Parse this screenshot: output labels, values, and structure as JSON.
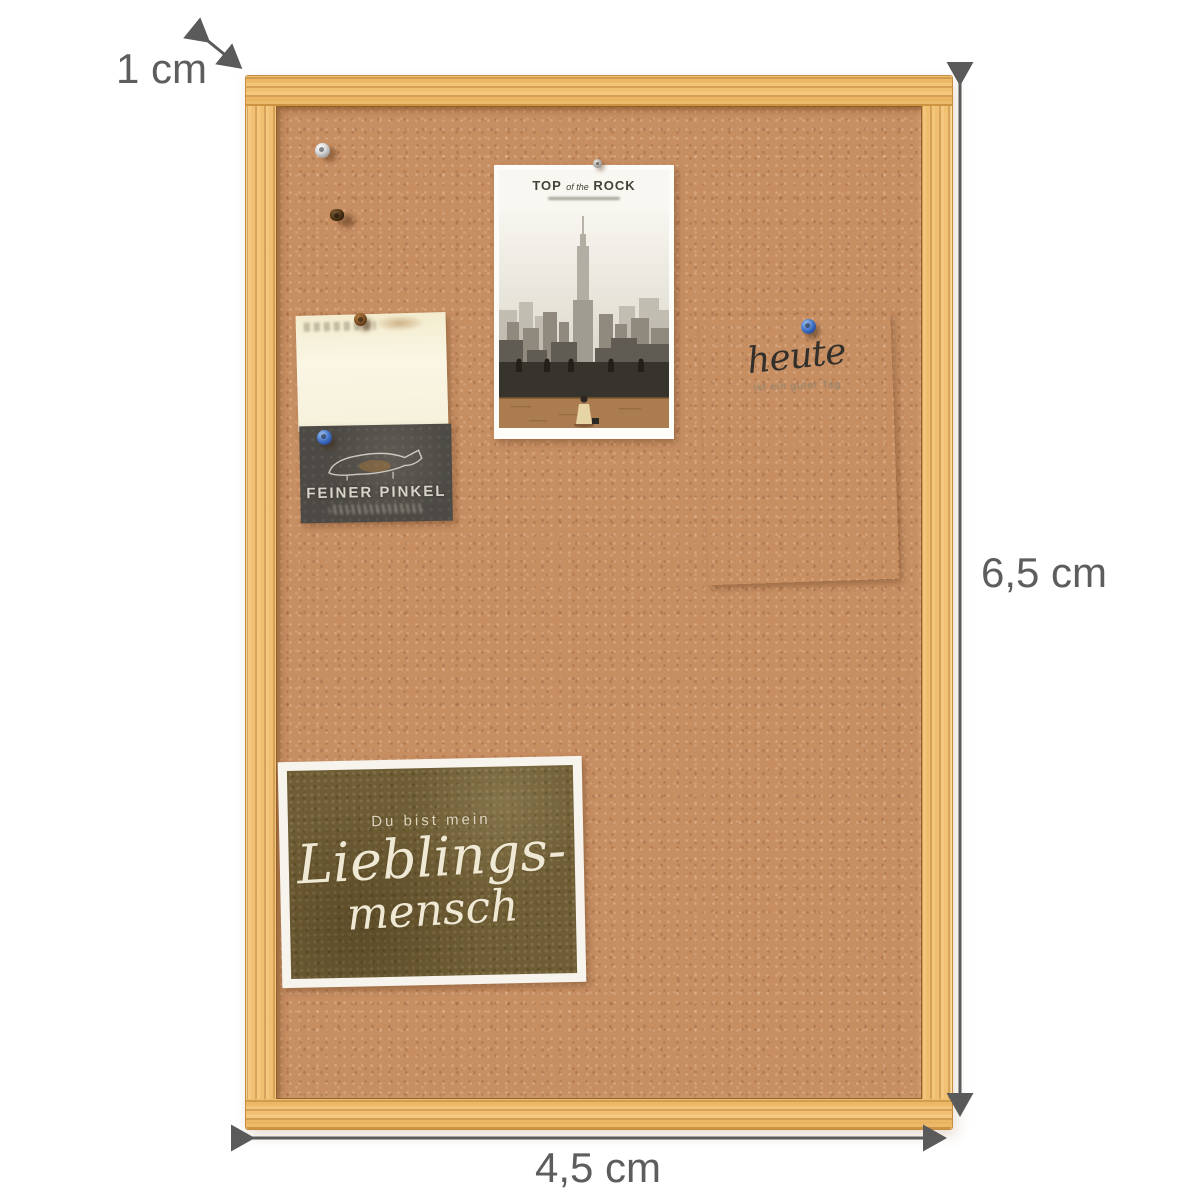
{
  "image_type": "product photo: cork pinboard with wooden frame and dimension arrows",
  "dimensions": {
    "frame_width_label": "1 cm",
    "board_height_label": "6,5 cm",
    "board_width_label": "4,5 cm"
  },
  "colors": {
    "background": "#ffffff",
    "wood_frame": "#eab763",
    "wood_grain": "#b97f3a",
    "cork": "#c78e62",
    "dimension_gray": "#5d5d5d",
    "lieblings_card_bg": "#6f5d35",
    "feiner_card_bg": "#4d4a45",
    "pin_blue": "#3f6fc4",
    "pin_brown": "#7a4d22",
    "pin_silver": "#c9c9c9"
  },
  "board_items": {
    "postcard_nyc": {
      "title_part1": "TOP",
      "title_part2": "of the",
      "title_part3": "ROCK",
      "description": "black-and-white New York skyline photo, woman in light dress on observation deck"
    },
    "note_cream": {
      "description": "blank cream note with faint print, brown pin"
    },
    "card_feiner_pinkel": {
      "title": "FEINER PINKEL",
      "description": "dark slate card with dachshund line drawing and script underline, blue pin"
    },
    "notepad_heute": {
      "title": "heute",
      "subtitle": "ist ein guter Tag"
    },
    "card_lieblingsmensch": {
      "line1": "Du bist mein",
      "line2": "Lieblings-",
      "line3": "mensch"
    }
  },
  "pins": [
    {
      "name": "silver push pin",
      "color": "silver"
    },
    {
      "name": "dark tack",
      "color": "dark brown"
    },
    {
      "name": "brown pin on cream note",
      "color": "brown"
    },
    {
      "name": "blue pin on feiner pinkel card",
      "color": "blue"
    },
    {
      "name": "blue pin on heute notepad",
      "color": "blue"
    },
    {
      "name": "small gray pin on postcard",
      "color": "gray"
    }
  ]
}
